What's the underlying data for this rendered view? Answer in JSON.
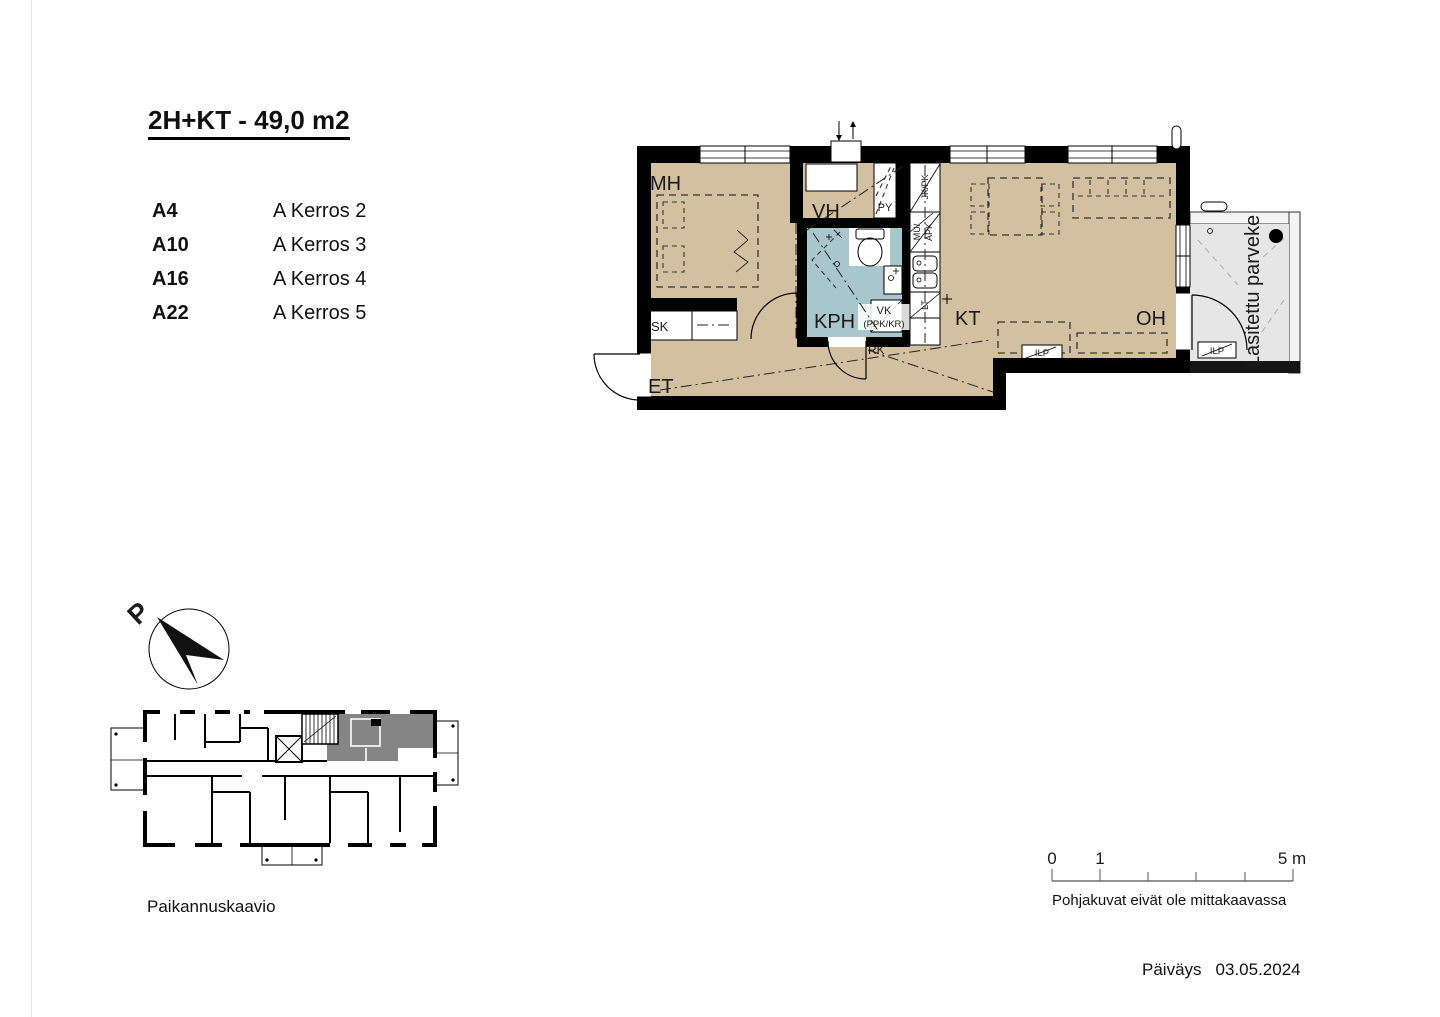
{
  "header": {
    "title": "2H+KT - 49,0 m2"
  },
  "apartment_list": [
    {
      "code": "A4",
      "floor": "A Kerros 2"
    },
    {
      "code": "A10",
      "floor": "A Kerros 3"
    },
    {
      "code": "A16",
      "floor": "A Kerros 4"
    },
    {
      "code": "A22",
      "floor": "A Kerros 5"
    }
  ],
  "plan": {
    "rooms": {
      "mh": "MH",
      "vh": "VH",
      "py": "PY",
      "kph": "KPH",
      "kt": "KT",
      "oh": "OH",
      "et": "ET",
      "sk": "SK"
    },
    "balcony_label": "Lasitettu parveke",
    "labels": {
      "jk_pk": "JK/PK",
      "mu": "MU/",
      "apk": "APK",
      "lt": "LT",
      "vk": "VK",
      "ppk_kr": "(PPK/KR)",
      "rk": "RK",
      "ilp_island": "ILP",
      "ilp_balcony": "ILP"
    }
  },
  "compass": {
    "north": "P"
  },
  "location_diagram": {
    "caption": "Paikannuskaavio"
  },
  "scale_bar": {
    "t0": "0",
    "t1": "1",
    "t5": "5 m",
    "note": "Pohjakuvat eivät ole mittakaavassa"
  },
  "footer": {
    "date_label": "Päiväys",
    "date_value": "03.05.2024"
  },
  "colors": {
    "floor": "#d2c0a0",
    "wet_room": "#aac6cd",
    "balcony_floor": "#e6e6e6",
    "wall": "#000000",
    "location_highlight": "#858585"
  }
}
